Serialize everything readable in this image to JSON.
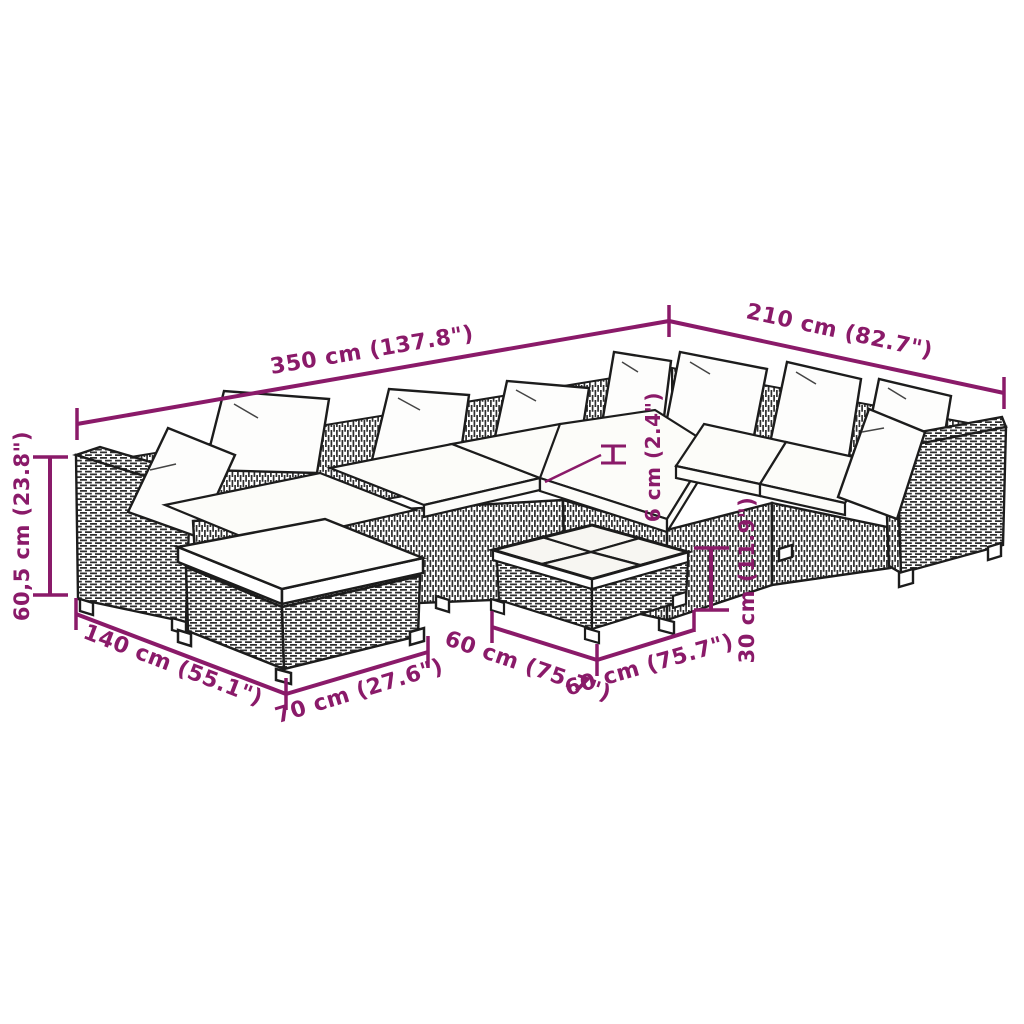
{
  "diagram": {
    "kind": "product-dimension-diagram",
    "subject": "poly rattan garden lounge set with corner sofa, footstool and coffee table",
    "background_color": "#ffffff",
    "accent_color": "#8a1a69",
    "line_color": "#1c1c1c",
    "labels": {
      "long_side": "350 cm (137.8\")",
      "short_side": "210 cm (82.7\")",
      "height": "60,5 cm (23.8\")",
      "depth_total": "140 cm (55.1\")",
      "footstool_width": "70 cm (27.6\")",
      "table_depth": "60 cm (75.7\")",
      "table_width": "60 cm (75.7\")",
      "table_height": "30 cm (11.9\")",
      "cushion_thickness": "6 cm (2.4\")"
    }
  }
}
